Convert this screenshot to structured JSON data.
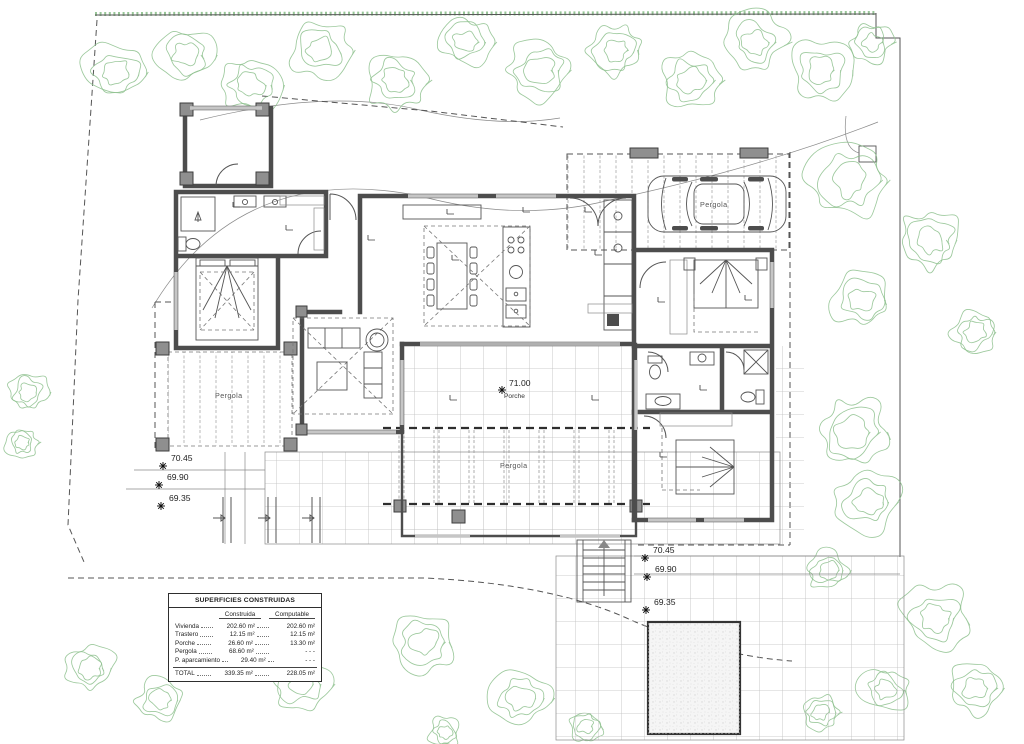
{
  "drawing": {
    "type": "architectural-floor-plan",
    "labels": {
      "pergola_left": "Pergola",
      "pergola_bottom": "Pergola",
      "pergola_carport": "Pergola",
      "porche": "Porche",
      "porche_level": "71.00"
    },
    "elevation_markers": {
      "left": [
        "70.45",
        "69.90",
        "69.35"
      ],
      "right": [
        "70.45",
        "69.90",
        "69.35"
      ]
    },
    "areas_table": {
      "title": "SUPERFICIES CONSTRUIDAS",
      "columns": [
        "Construida",
        "Computable"
      ],
      "rows": [
        {
          "name": "Vivienda",
          "construida": "202.60 m²",
          "computable": "202.60 m²"
        },
        {
          "name": "Trastero",
          "construida": "12.15 m²",
          "computable": "12.15 m²"
        },
        {
          "name": "Porche",
          "construida": "26.60 m²",
          "computable": "13.30 m²"
        },
        {
          "name": "Pergola",
          "construida": "68.60 m²",
          "computable": "- - -"
        },
        {
          "name": "P. aparcamiento",
          "construida": "29.40 m²",
          "computable": "- - -"
        }
      ],
      "total": {
        "name": "TOTAL",
        "construida": "339.35 m²",
        "computable": "228.05 m²"
      }
    },
    "colors": {
      "tree_green": "#8cbf8c",
      "wall_dark": "#4d4d4d",
      "line": "#555555"
    }
  }
}
